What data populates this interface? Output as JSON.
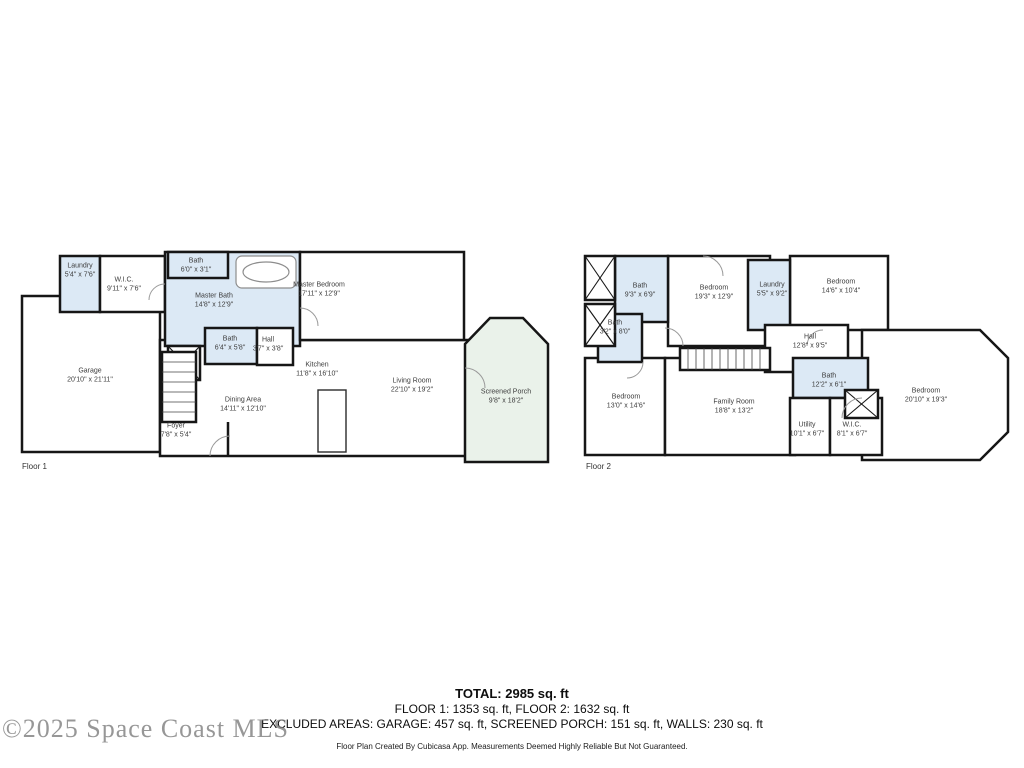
{
  "watermark": "©2025 Space Coast MLS",
  "colors": {
    "wall": "#161616",
    "wet_room_fill": "#dce9f5",
    "porch_fill": "#eaf2ea",
    "room_fill": "#ffffff",
    "watermark_gray": "#7d7d7d"
  },
  "floors": [
    {
      "label": "Floor 1",
      "rooms": [
        {
          "name": "Laundry",
          "dims": "5'4\" x 7'6\""
        },
        {
          "name": "W.I.C.",
          "dims": "9'11\" x 7'6\""
        },
        {
          "name": "Bath",
          "dims": "6'0\" x 3'1\""
        },
        {
          "name": "Master Bath",
          "dims": "14'8\" x 12'9\""
        },
        {
          "name": "Master Bedroom",
          "dims": "17'11\" x 12'9\""
        },
        {
          "name": "Garage",
          "dims": "20'10\" x 21'11\""
        },
        {
          "name": "Bath",
          "dims": "6'4\" x 5'8\""
        },
        {
          "name": "Hall",
          "dims": "3'7\" x 3'8\""
        },
        {
          "name": "Kitchen",
          "dims": "11'8\" x 16'10\""
        },
        {
          "name": "Dining Area",
          "dims": "14'11\" x 12'10\""
        },
        {
          "name": "Living Room",
          "dims": "22'10\" x 19'2\""
        },
        {
          "name": "Foyer",
          "dims": "7'8\" x 5'4\""
        },
        {
          "name": "Screened Porch",
          "dims": "9'8\" x 18'2\""
        }
      ]
    },
    {
      "label": "Floor 2",
      "rooms": [
        {
          "name": "Bath",
          "dims": "9'3\" x 6'9\""
        },
        {
          "name": "Bedroom",
          "dims": "19'3\" x 12'9\""
        },
        {
          "name": "Laundry",
          "dims": "5'5\" x 9'2\""
        },
        {
          "name": "Bedroom",
          "dims": "14'6\" x 10'4\""
        },
        {
          "name": "Bath",
          "dims": "3'2\" x 8'0\""
        },
        {
          "name": "Hall",
          "dims": "12'8\" x 9'5\""
        },
        {
          "name": "Bedroom",
          "dims": "13'0\" x 14'6\""
        },
        {
          "name": "Family Room",
          "dims": "18'8\" x 13'2\""
        },
        {
          "name": "Bath",
          "dims": "12'2\" x 6'1\""
        },
        {
          "name": "Utility",
          "dims": "10'1\" x 6'7\""
        },
        {
          "name": "W.I.C.",
          "dims": "8'1\" x 6'7\""
        },
        {
          "name": "Bedroom",
          "dims": "20'10\" x 19'3\""
        }
      ]
    }
  ],
  "summary": {
    "total": "TOTAL: 2985 sq. ft",
    "floors_line": "FLOOR 1: 1353 sq. ft, FLOOR 2: 1632 sq. ft",
    "excluded_line": "EXCLUDED AREAS: GARAGE: 457 sq. ft, SCREENED PORCH: 151 sq. ft, WALLS: 230 sq. ft",
    "disclaimer": "Floor Plan Created By Cubicasa App. Measurements Deemed Highly Reliable But Not Guaranteed."
  }
}
